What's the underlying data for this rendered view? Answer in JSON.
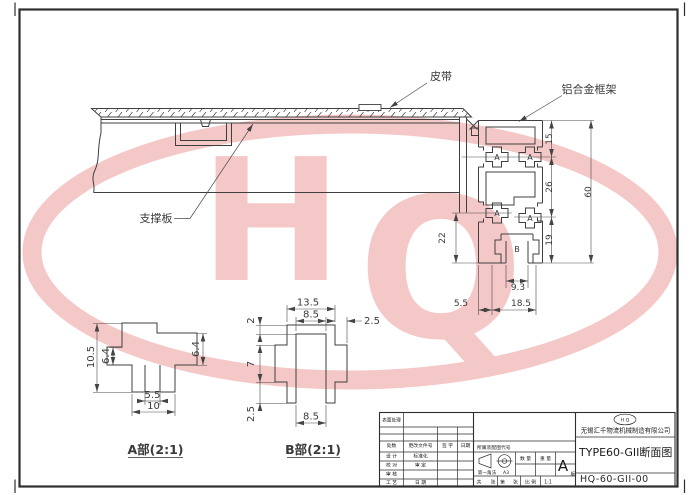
{
  "drawing": {
    "callouts": {
      "belt": "皮带",
      "frame": "铝合金框架",
      "support_plate": "支撑板"
    },
    "profile_dims": {
      "d15": "15",
      "d26": "26",
      "d19": "19",
      "d60": "60",
      "d22": "22",
      "d9_3": "9.3",
      "d5_5": "5.5",
      "d18_5": "18.5"
    },
    "marks": {
      "a": "A",
      "b": "B"
    },
    "detail_a": {
      "title": "A部(2:1)",
      "d10_5": "10.5",
      "d6_4_left": "6.4",
      "d6_4_right": "6.4",
      "d5_5": "5.5",
      "d10": "10"
    },
    "detail_b": {
      "title": "B部(2:1)",
      "d13_5": "13.5",
      "d8_5_top": "8.5",
      "d2_5_right": "2.5",
      "d2": "2",
      "d7": "7",
      "d2_5_bottom": "2.5",
      "d8_5_bottom": "8.5"
    }
  },
  "watermark": {
    "letter_h": "H",
    "letter_q": "Q",
    "color": "#f5c8c8"
  },
  "title_block": {
    "surface_label": "表面处理",
    "rev_header": {
      "c1": "处数",
      "c2": "更改文件号",
      "c3": "签 字",
      "c4": "日期"
    },
    "sig_rows": [
      {
        "l": "设 计",
        "r": "标准化"
      },
      {
        "l": "校 对",
        "r": "审 定"
      },
      {
        "l": "审 核",
        "r": ""
      },
      {
        "l": "工 艺",
        "r": "日 期"
      }
    ],
    "assembly_label": "所属装配图代号",
    "projection_label": "第一角法",
    "sheet_size": "A3",
    "qty_label": "数 量",
    "weight_label": "重 量",
    "version_letter": "A",
    "version_sub": "版",
    "sheets": {
      "total_label": "共",
      "total_unit": "张",
      "no_label": "第",
      "no_unit": "张",
      "scale_label": "比 例",
      "scale_value": "1:1"
    },
    "logo_text": "H Q",
    "company": "无锡汇千物流机械制造有限公司",
    "drawing_title": "TYPE60-GII断面图",
    "drawing_no": "HQ-60-GII-00"
  }
}
